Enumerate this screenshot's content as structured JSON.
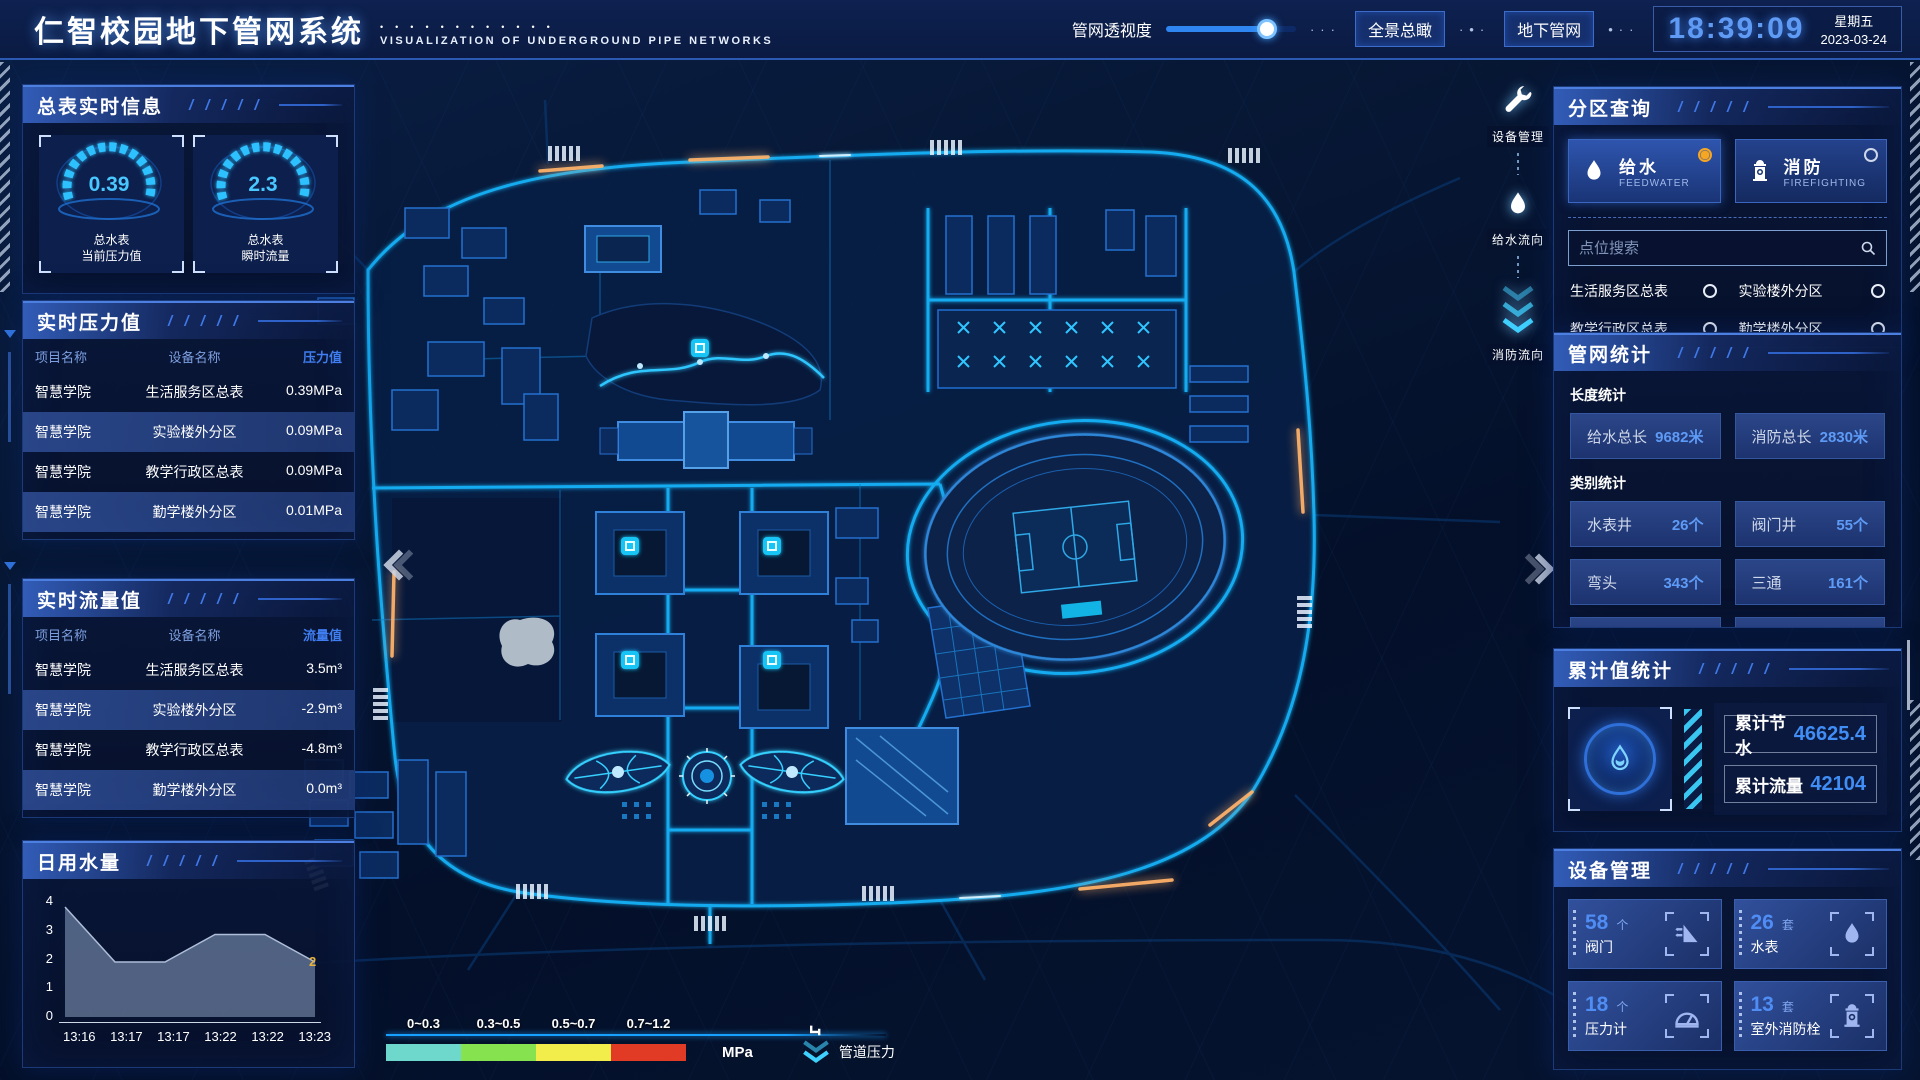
{
  "header": {
    "title": "仁智校园地下管网系统",
    "subtitle": "VISUALIZATION OF UNDERGROUND PIPE NETWORKS",
    "slider_label": "管网透视度",
    "slider_value": 78,
    "btn_overview": "全景总瞰",
    "btn_underground": "地下管网",
    "clock": "18:39:09",
    "weekday": "星期五",
    "date": "2023-03-24"
  },
  "left": {
    "meter_panel": {
      "title": "总表实时信息",
      "gauges": [
        {
          "value": "0.39",
          "label1": "总水表",
          "label2": "当前压力值"
        },
        {
          "value": "2.3",
          "label1": "总水表",
          "label2": "瞬时流量"
        }
      ]
    },
    "pressure_panel": {
      "title": "实时压力值",
      "columns": [
        "项目名称",
        "设备名称",
        "压力值"
      ],
      "rows": [
        [
          "智慧学院",
          "生活服务区总表",
          "0.39MPa"
        ],
        [
          "智慧学院",
          "实验楼外分区",
          "0.09MPa"
        ],
        [
          "智慧学院",
          "教学行政区总表",
          "0.09MPa"
        ],
        [
          "智慧学院",
          "勤学楼外分区",
          "0.01MPa"
        ],
        [
          "智慧学院",
          "砺学楼外分区",
          "0.02MPa"
        ]
      ]
    },
    "flow_panel": {
      "title": "实时流量值",
      "columns": [
        "项目名称",
        "设备名称",
        "流量值"
      ],
      "rows": [
        [
          "智慧学院",
          "生活服务区总表",
          "3.5m³"
        ],
        [
          "智慧学院",
          "实验楼外分区",
          "-2.9m³"
        ],
        [
          "智慧学院",
          "教学行政区总表",
          "-4.8m³"
        ],
        [
          "智慧学院",
          "勤学楼外分区",
          "0.0m³"
        ],
        [
          "智慧学院",
          "砺学楼外分区",
          "2.3m³"
        ]
      ]
    },
    "daily_panel": {
      "title": "日用水量"
    }
  },
  "chart_data": {
    "type": "area",
    "title": "日用水量",
    "x": [
      "13:16",
      "13:17",
      "13:17",
      "13:22",
      "13:22",
      "13:23"
    ],
    "values": [
      4,
      2,
      2,
      3,
      3,
      2
    ],
    "ylim": [
      0,
      4
    ],
    "yticks": [
      0,
      1,
      2,
      3,
      4
    ],
    "end_label": "2",
    "area_color": "#8da3c4",
    "grid": false,
    "legend_position": "none"
  },
  "right": {
    "zone_panel": {
      "title": "分区查询",
      "feedwater": {
        "zh": "给水",
        "en": "FEEDWATER",
        "selected": true
      },
      "firefighting": {
        "zh": "消防",
        "en": "FIREFIGHTING",
        "selected": false
      },
      "search_placeholder": "点位搜索",
      "items": [
        "生活服务区总表",
        "实验楼外分区",
        "教学行政区总表",
        "勤学楼外分区",
        "砺学楼外分区",
        "宿舍区泵房"
      ]
    },
    "stats_panel": {
      "title": "管网统计",
      "length_label": "长度统计",
      "length_items": [
        {
          "label": "给水总长",
          "value": "9682米"
        },
        {
          "label": "消防总长",
          "value": "2830米"
        }
      ],
      "category_label": "类别统计",
      "category_items": [
        {
          "label": "水表井",
          "value": "26个"
        },
        {
          "label": "阀门井",
          "value": "55个"
        },
        {
          "label": "弯头",
          "value": "343个"
        },
        {
          "label": "三通",
          "value": "161个"
        }
      ]
    },
    "cumulative_panel": {
      "title": "累计值统计",
      "items": [
        {
          "label": "累计节水",
          "value": "46625.4"
        },
        {
          "label": "累计流量",
          "value": "42104"
        }
      ]
    },
    "device_panel": {
      "title": "设备管理",
      "cards": [
        {
          "count": "58",
          "unit": "个",
          "label": "阀门"
        },
        {
          "count": "26",
          "unit": "套",
          "label": "水表"
        },
        {
          "count": "18",
          "unit": "个",
          "label": "压力计"
        },
        {
          "count": "13",
          "unit": "套",
          "label": "室外消防栓"
        }
      ]
    }
  },
  "map": {
    "tools": [
      {
        "label": "设备管理"
      },
      {
        "label": "给水流向"
      },
      {
        "label": "消防流向"
      }
    ],
    "legend": {
      "ranges": [
        "0~0.3",
        "0.3~0.5",
        "0.5~0.7",
        "0.7~1.2"
      ],
      "colors": [
        "#6fd8cc",
        "#86e34f",
        "#f2ed4a",
        "#e23b25"
      ],
      "unit": "MPa",
      "pressure_label": "管道压力"
    }
  },
  "colors": {
    "accent_cyan": "#15b8ff",
    "accent_blue": "#2f86f0",
    "value_blue": "#4f8df5",
    "radio_orange": "#f5a623",
    "panel_border": "#1c3a78"
  }
}
